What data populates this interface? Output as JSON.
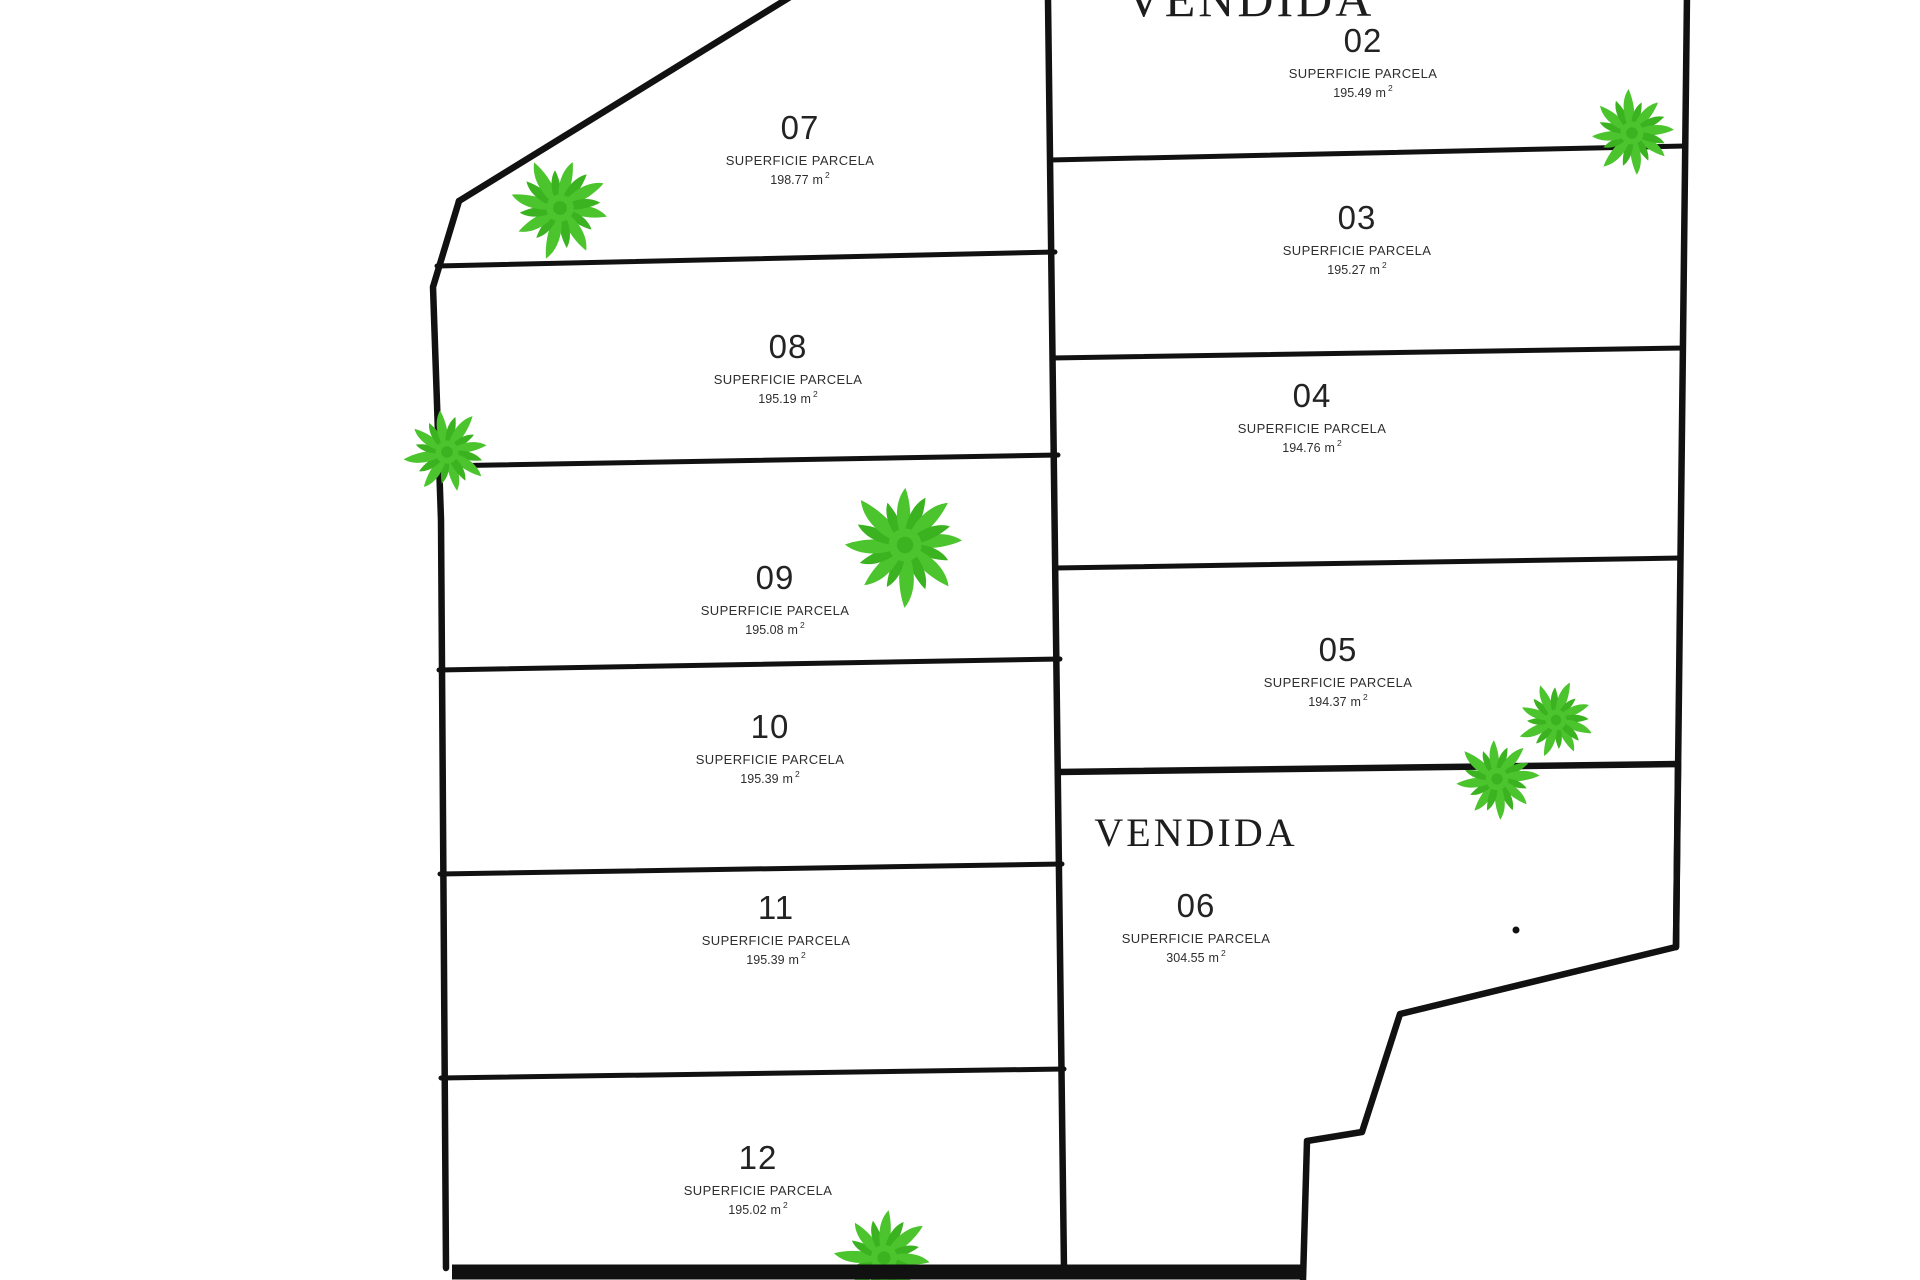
{
  "drawing": {
    "type": "land-subdivision-plan",
    "sold_label": "VENDIDA"
  },
  "colors": {
    "line": "#111111",
    "plant_green": "#4cc42e",
    "plant_green_dark": "#3bb220",
    "background": "#ffffff",
    "text": "#2b2b2b"
  },
  "icons": {
    "plant_icon": "palm-starburst-plant"
  },
  "parcels": [
    {
      "id": "02",
      "status": "VENDIDA",
      "superficie_label": "SUPERFICIE PARCELA",
      "area": "195.49",
      "unit": "m",
      "exponent": "2"
    },
    {
      "id": "03",
      "superficie_label": "SUPERFICIE PARCELA",
      "area": "195.27",
      "unit": "m",
      "exponent": "2"
    },
    {
      "id": "04",
      "superficie_label": "SUPERFICIE PARCELA",
      "area": "194.76",
      "unit": "m",
      "exponent": "2"
    },
    {
      "id": "05",
      "superficie_label": "SUPERFICIE PARCELA",
      "area": "194.37",
      "unit": "m",
      "exponent": "2"
    },
    {
      "id": "06",
      "status": "VENDIDA",
      "superficie_label": "SUPERFICIE PARCELA",
      "area": "304.55",
      "unit": "m",
      "exponent": "2"
    },
    {
      "id": "07",
      "superficie_label": "SUPERFICIE PARCELA",
      "area": "198.77",
      "unit": "m",
      "exponent": "2"
    },
    {
      "id": "08",
      "superficie_label": "SUPERFICIE PARCELA",
      "area": "195.19",
      "unit": "m",
      "exponent": "2"
    },
    {
      "id": "09",
      "superficie_label": "SUPERFICIE PARCELA",
      "area": "195.08",
      "unit": "m",
      "exponent": "2"
    },
    {
      "id": "10",
      "superficie_label": "SUPERFICIE PARCELA",
      "area": "195.39",
      "unit": "m",
      "exponent": "2"
    },
    {
      "id": "11",
      "superficie_label": "SUPERFICIE PARCELA",
      "area": "195.39",
      "unit": "m",
      "exponent": "2"
    },
    {
      "id": "12",
      "superficie_label": "SUPERFICIE PARCELA",
      "area": "195.02",
      "unit": "m",
      "exponent": "2"
    }
  ]
}
